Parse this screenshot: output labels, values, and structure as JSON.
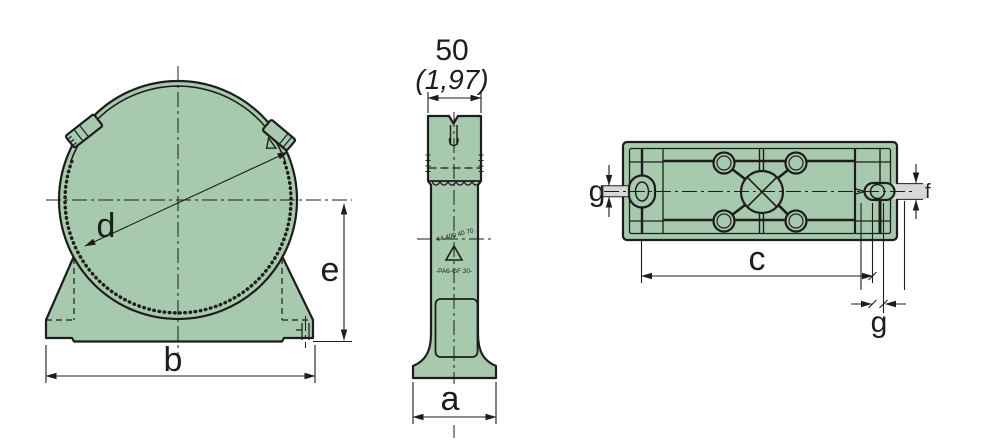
{
  "drawing": {
    "kind": "technical-drawing-pipe-clamp",
    "views": {
      "front": {
        "labels": {
          "d": "d",
          "b": "b",
          "e": "e"
        }
      },
      "side": {
        "labels": {
          "width_mm": "50",
          "width_inch": "(1,97)",
          "a": "a"
        },
        "markings": {
          "code": "44 400 40 70",
          "material": "-PA6-GF 30-"
        }
      },
      "bottom": {
        "labels": {
          "c": "c",
          "f": "f",
          "g_left": "g",
          "g_bottom": "g"
        }
      }
    },
    "colors": {
      "part_fill": "#a7caae",
      "line": "#1d1d1b",
      "shade": "#d8d8d8",
      "background": "#ffffff"
    }
  }
}
